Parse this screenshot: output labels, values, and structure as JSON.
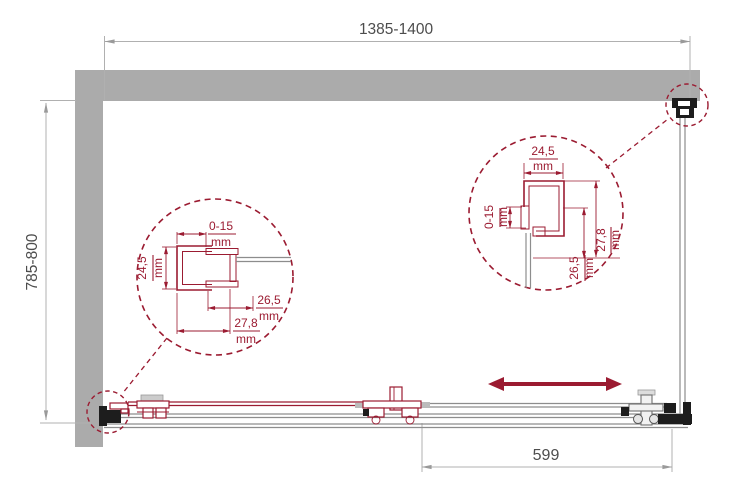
{
  "drawing": {
    "type": "shower-enclosure-plan-technical-drawing",
    "dimensions": {
      "width": "1385-1400",
      "depth": "785-800",
      "opening": "599"
    },
    "detail_left": {
      "range": "0-15",
      "range_unit": "mm",
      "profile": "24,5",
      "profile_unit": "mm",
      "inner": "26,5",
      "inner_unit": "mm",
      "outer": "27,8",
      "outer_unit": "mm"
    },
    "detail_right": {
      "width": "24,5",
      "width_unit": "mm",
      "range": "0-15",
      "range_unit": "mm",
      "inner": "26,5",
      "inner_unit": "mm",
      "outer": "27,8",
      "outer_unit": "mm"
    },
    "icons": {
      "slide_arrow": "double-headed-slide-direction-arrow"
    }
  },
  "colors": {
    "accent": "#9b1b31",
    "wall": "#ababab",
    "line": "#8d8d8d",
    "dim_line": "#b0b0b0",
    "text": "#4d4d4d",
    "fitting": "#1d1d1d",
    "background": "#ffffff"
  }
}
